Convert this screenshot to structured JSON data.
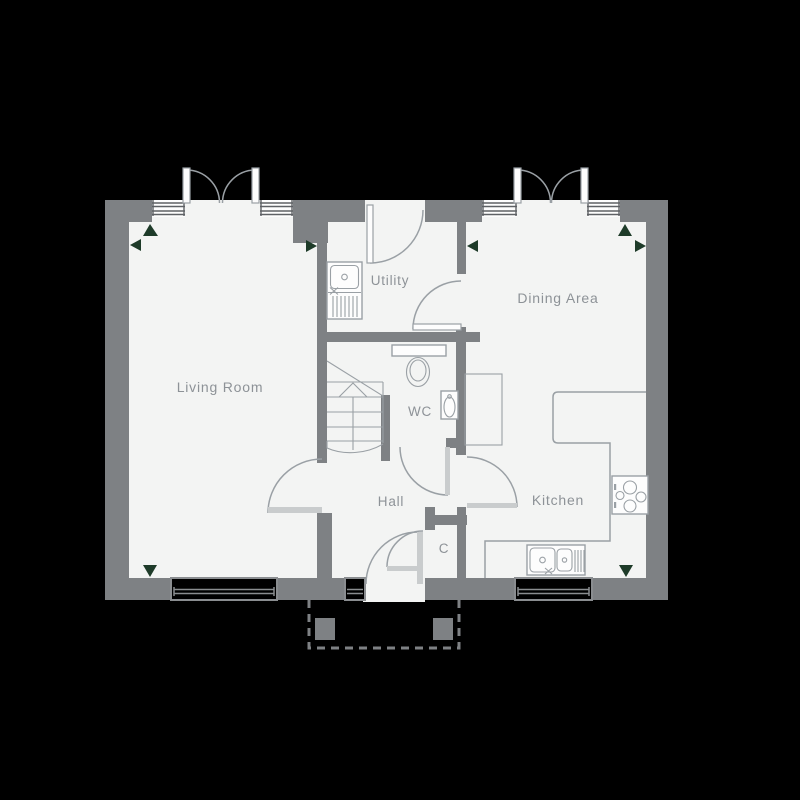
{
  "plan": {
    "rooms": [
      {
        "id": "living-room",
        "label": "Living Room"
      },
      {
        "id": "utility",
        "label": "Utility"
      },
      {
        "id": "dining-area",
        "label": "Dining Area"
      },
      {
        "id": "wc",
        "label": "WC"
      },
      {
        "id": "hall",
        "label": "Hall"
      },
      {
        "id": "kitchen",
        "label": "Kitchen"
      },
      {
        "id": "cupboard",
        "label": "C"
      }
    ],
    "fixtures": [
      "utility-sink",
      "toilet",
      "basin",
      "stairs",
      "kitchen-counter",
      "kitchen-sink",
      "hob",
      "tall-unit",
      "french-doors",
      "porch-posts"
    ],
    "colors": {
      "background": "#000000",
      "floor": "#f3f4f3",
      "wall": "#7e8184",
      "fixture_line": "#9aa0a5",
      "window_line": "#5e6165",
      "door_leaf": "#c9cccd",
      "marker": "#1e3b29",
      "label": "#8d9297"
    }
  }
}
